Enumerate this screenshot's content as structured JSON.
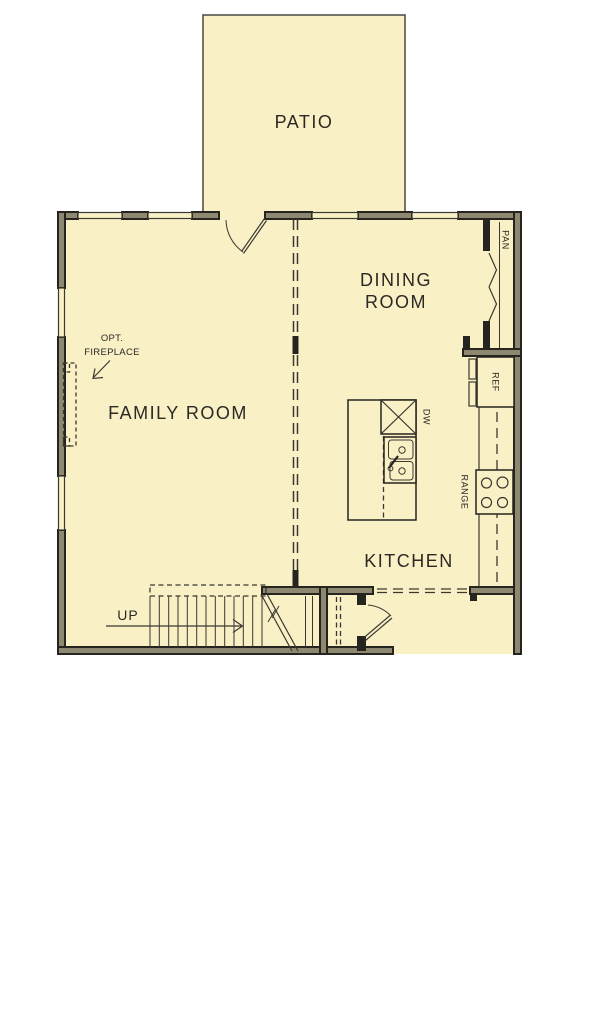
{
  "plan": {
    "colors": {
      "background": "#ffffff",
      "floor": "#faf0c6",
      "wall_outline": "#26241f",
      "wall_core": "#8f8871",
      "line": "#3b3831",
      "text": "#2b2923"
    },
    "rooms": [
      {
        "id": "patio",
        "label": "PATIO"
      },
      {
        "id": "dining-room",
        "label": "DINING ROOM",
        "label_line1": "DINING",
        "label_line2": "ROOM"
      },
      {
        "id": "family-room",
        "label": "FAMILY ROOM"
      },
      {
        "id": "kitchen",
        "label": "KITCHEN"
      }
    ],
    "fixtures": {
      "pantry": "PAN",
      "refrigerator": "REF",
      "dishwasher": "DW",
      "range": "RANGE"
    },
    "annotations": {
      "fireplace_line1": "OPT.",
      "fireplace_line2": "FIREPLACE",
      "stairs_up": "UP"
    }
  }
}
